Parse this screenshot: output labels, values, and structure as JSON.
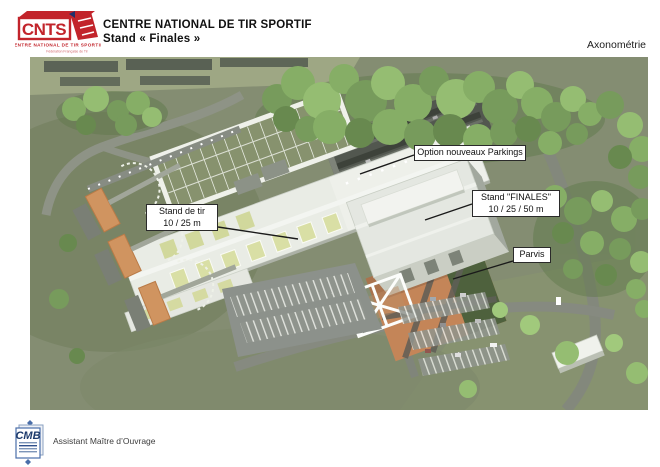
{
  "header": {
    "logo": {
      "acronym": "CNTS",
      "line1": "CENTRE NATIONAL DE TIR SPORTIF",
      "line2": "Fédération Française de Tir"
    },
    "title_line1": "CENTRE NATIONAL DE TIR SPORTIF",
    "title_line2": "Stand « Finales »",
    "view_label": "Axonométrie"
  },
  "annotations": {
    "parkings": {
      "label": "Option nouveaux Parkings"
    },
    "finales": {
      "line1": "Stand \"FINALES\"",
      "line2": "10 / 25 / 50 m"
    },
    "stand_de_tir": {
      "line1": "Stand de tir",
      "line2": "10 / 25 m"
    },
    "parvis": {
      "label": "Parvis"
    }
  },
  "footer": {
    "logo_acronym": "CMB",
    "role": "Assistant Maître d’Ouvrage"
  },
  "colors": {
    "logo_red": "#c2242b",
    "cmb_blue": "#1d3a6b"
  }
}
